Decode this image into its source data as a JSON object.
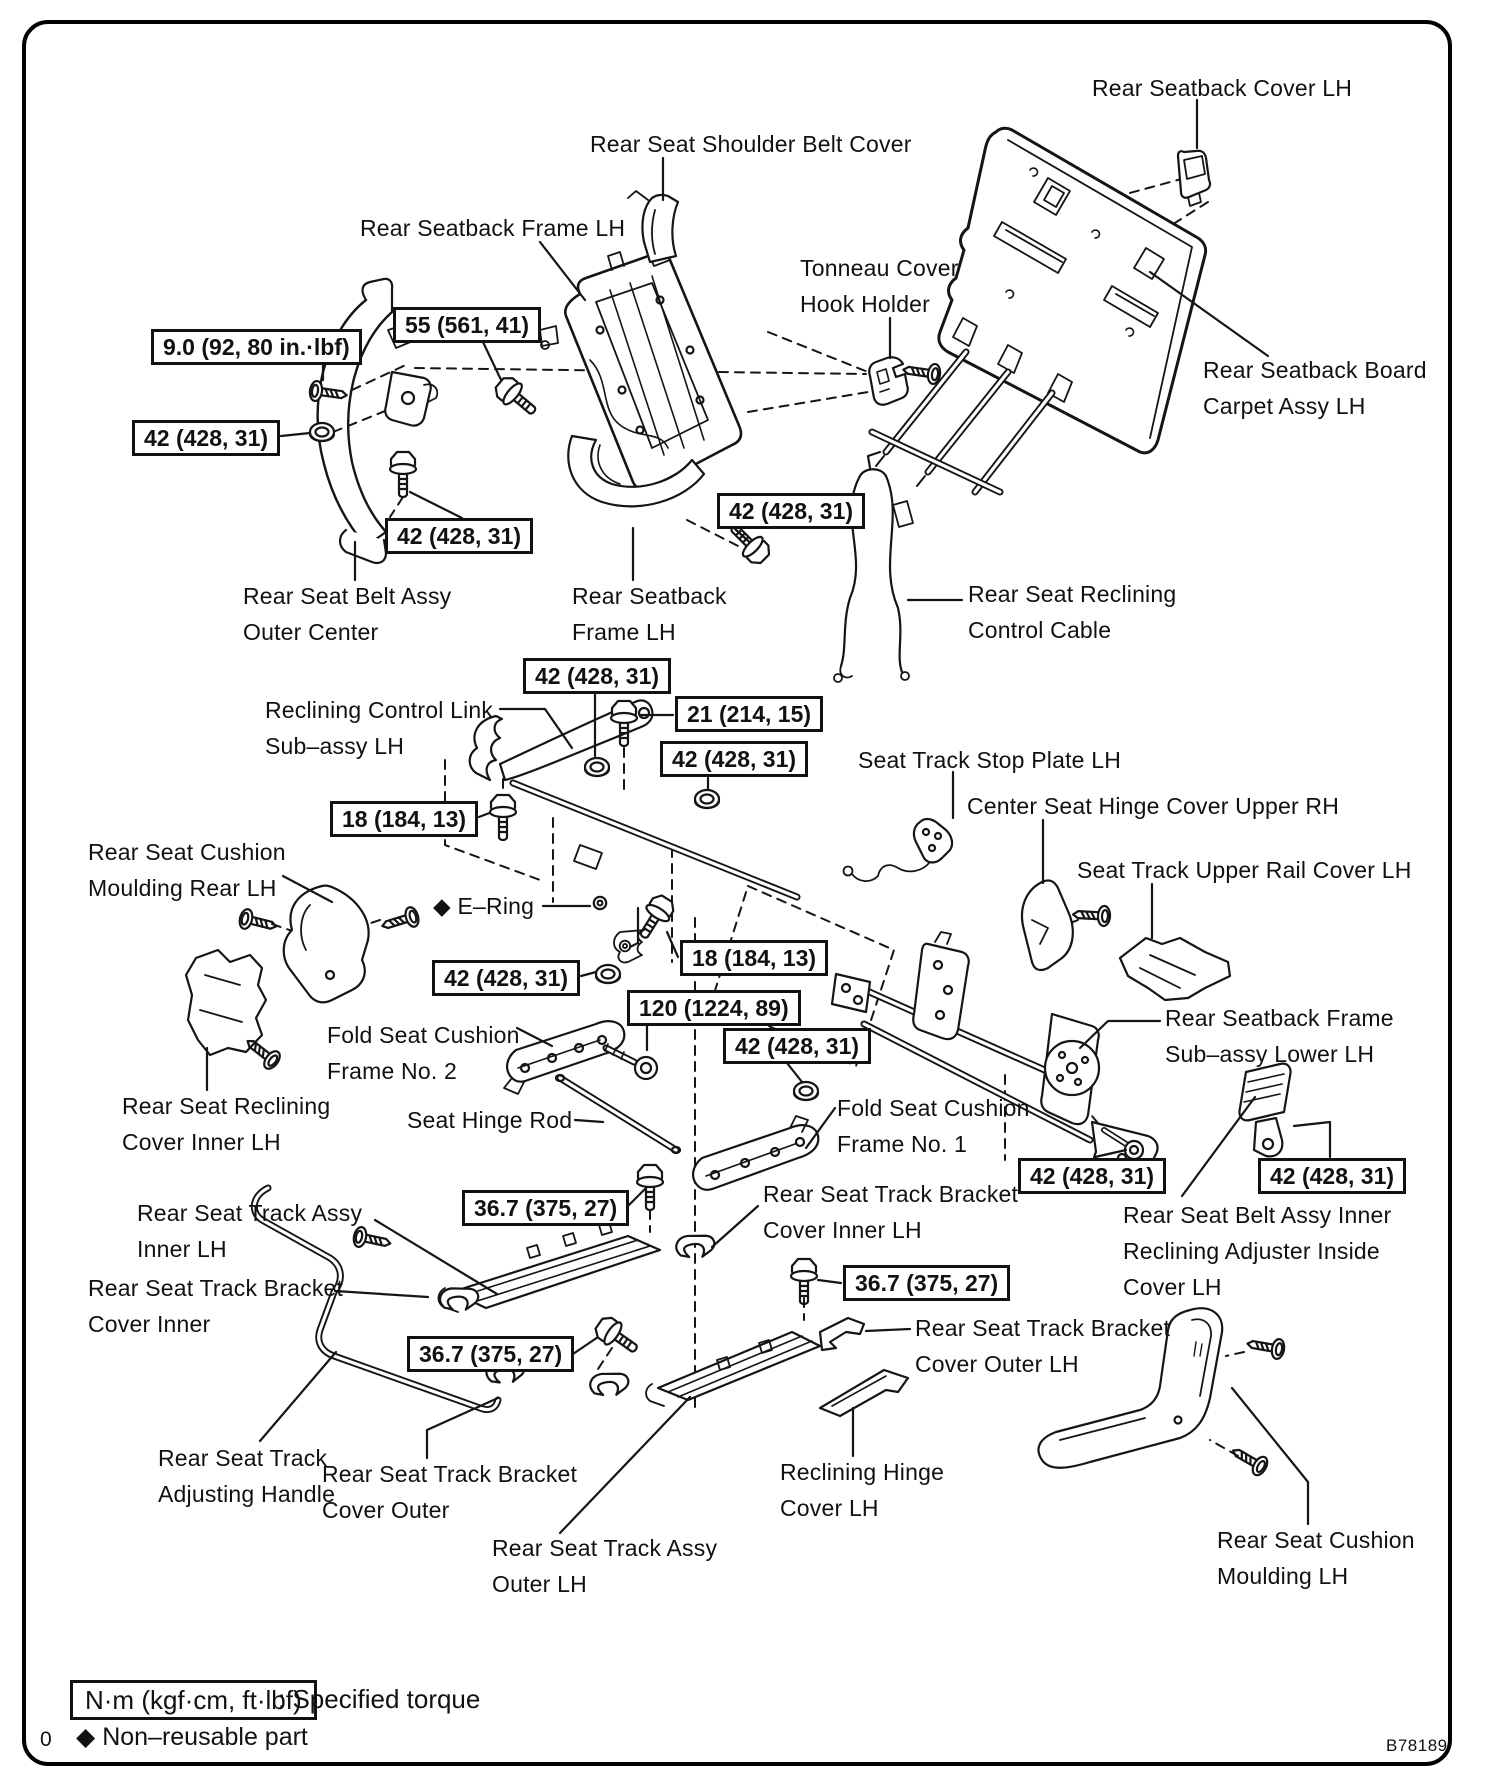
{
  "page": {
    "code": "B78189",
    "page_char": "0"
  },
  "legend": {
    "torque_box": "N·m (kgf·cm, ft·lbf)",
    "torque_note": ": Specified torque",
    "diamond": "◆",
    "non_reusable": "Non–reusable part"
  },
  "torque_boxes": [
    {
      "id": "t-9-0",
      "x": 151,
      "y": 329,
      "value": "9.0 (92, 80 in.·lbf)"
    },
    {
      "id": "t-55",
      "x": 393,
      "y": 307,
      "value": "55 (561, 41)"
    },
    {
      "id": "t-42-a",
      "x": 132,
      "y": 420,
      "value": "42 (428, 31)"
    },
    {
      "id": "t-42-b",
      "x": 385,
      "y": 518,
      "value": "42 (428, 31)"
    },
    {
      "id": "t-42-c",
      "x": 717,
      "y": 493,
      "value": "42 (428, 31)"
    },
    {
      "id": "t-42-d",
      "x": 523,
      "y": 658,
      "value": "42 (428, 31)"
    },
    {
      "id": "t-21",
      "x": 675,
      "y": 696,
      "value": "21 (214, 15)"
    },
    {
      "id": "t-42-e",
      "x": 660,
      "y": 741,
      "value": "42 (428, 31)"
    },
    {
      "id": "t-18-a",
      "x": 330,
      "y": 801,
      "value": "18 (184, 13)"
    },
    {
      "id": "t-18-b",
      "x": 680,
      "y": 940,
      "value": "18 (184, 13)"
    },
    {
      "id": "t-42-f",
      "x": 432,
      "y": 960,
      "value": "42 (428, 31)"
    },
    {
      "id": "t-120",
      "x": 627,
      "y": 990,
      "value": "120 (1224, 89)"
    },
    {
      "id": "t-42-g",
      "x": 723,
      "y": 1028,
      "value": "42 (428, 31)"
    },
    {
      "id": "t-36-a",
      "x": 462,
      "y": 1190,
      "value": "36.7 (375, 27)"
    },
    {
      "id": "t-36-b",
      "x": 407,
      "y": 1336,
      "value": "36.7 (375, 27)"
    },
    {
      "id": "t-36-c",
      "x": 843,
      "y": 1265,
      "value": "36.7 (375, 27)"
    },
    {
      "id": "t-42-h",
      "x": 1018,
      "y": 1158,
      "value": "42 (428, 31)"
    },
    {
      "id": "t-42-i",
      "x": 1258,
      "y": 1158,
      "value": "42 (428, 31)"
    }
  ],
  "part_labels": [
    {
      "id": "rear-seatback-cover-lh",
      "x": 1092,
      "y": 70,
      "lines": [
        "Rear Seatback Cover LH"
      ]
    },
    {
      "id": "rear-seat-shoulder-belt-cover",
      "x": 590,
      "y": 126,
      "lines": [
        "Rear Seat Shoulder Belt Cover"
      ]
    },
    {
      "id": "rear-seatback-frame-lh-top",
      "x": 360,
      "y": 210,
      "lines": [
        "Rear Seatback Frame LH"
      ]
    },
    {
      "id": "tonneau-cover-hook-holder",
      "x": 800,
      "y": 250,
      "lines": [
        "Tonneau Cover",
        "Hook Holder"
      ]
    },
    {
      "id": "rear-seatback-board-carpet-assy",
      "x": 1203,
      "y": 352,
      "lines": [
        "Rear Seatback Board",
        "Carpet Assy LH"
      ]
    },
    {
      "id": "rear-seat-belt-assy-outer-center",
      "x": 243,
      "y": 578,
      "lines": [
        "Rear Seat Belt Assy",
        "Outer Center"
      ]
    },
    {
      "id": "rear-seatback-frame-lh-mid",
      "x": 572,
      "y": 578,
      "lines": [
        "Rear Seatback",
        "Frame LH"
      ]
    },
    {
      "id": "rear-seat-reclining-control-cable",
      "x": 968,
      "y": 576,
      "lines": [
        "Rear Seat Reclining",
        "Control Cable"
      ]
    },
    {
      "id": "reclining-control-link-sub-assy",
      "x": 265,
      "y": 692,
      "lines": [
        "Reclining Control Link",
        "Sub–assy LH"
      ]
    },
    {
      "id": "seat-track-stop-plate-lh",
      "x": 858,
      "y": 742,
      "lines": [
        "Seat Track Stop Plate LH"
      ]
    },
    {
      "id": "center-seat-hinge-cover-upper-rh",
      "x": 967,
      "y": 788,
      "lines": [
        "Center Seat Hinge Cover Upper RH"
      ]
    },
    {
      "id": "seat-track-upper-rail-cover-lh",
      "x": 1077,
      "y": 852,
      "lines": [
        "Seat Track Upper Rail Cover LH"
      ]
    },
    {
      "id": "rear-seat-cushion-moulding-rear-lh",
      "x": 88,
      "y": 834,
      "lines": [
        "Rear Seat Cushion",
        "Moulding Rear LH"
      ]
    },
    {
      "id": "e-ring",
      "x": 433,
      "y": 888,
      "lines": [
        "◆ E–Ring"
      ]
    },
    {
      "id": "fold-seat-cushion-frame-no-2",
      "x": 327,
      "y": 1017,
      "lines": [
        "Fold Seat Cushion",
        "Frame No. 2"
      ]
    },
    {
      "id": "rear-seat-reclining-cover-inner-lh",
      "x": 122,
      "y": 1088,
      "lines": [
        "Rear Seat Reclining",
        "Cover In​ner LH"
      ]
    },
    {
      "id": "seat-hinge-rod",
      "x": 407,
      "y": 1102,
      "lines": [
        "Seat Hinge Rod"
      ]
    },
    {
      "id": "fold-seat-cushion-frame-no-1",
      "x": 837,
      "y": 1090,
      "lines": [
        "Fold Seat Cushion",
        "Frame No. 1"
      ]
    },
    {
      "id": "rear-seatback-frame-sub-assy-lower",
      "x": 1165,
      "y": 1000,
      "lines": [
        "Rear Seatback Frame",
        "Sub–assy Lower LH"
      ]
    },
    {
      "id": "rear-seat-belt-assy-inner",
      "x": 1123,
      "y": 1197,
      "lines": [
        "Rear Seat Belt Assy Inner",
        "Reclining Adjuster Inside",
        "Cover LH"
      ]
    },
    {
      "id": "rear-seat-track-assy-inner-lh",
      "x": 137,
      "y": 1195,
      "lines": [
        "Rear Seat Track Assy",
        "Inner LH"
      ]
    },
    {
      "id": "rear-seat-track-bracket-cover-inner",
      "x": 88,
      "y": 1270,
      "lines": [
        "Rear Seat Track Bracket",
        "Cover Inner"
      ]
    },
    {
      "id": "rear-seat-track-bracket-cover-inner-lh",
      "x": 763,
      "y": 1176,
      "lines": [
        "Rear Seat Track Bracket",
        "Cover Inner LH"
      ]
    },
    {
      "id": "rear-seat-track-bracket-cover-outer-lh",
      "x": 915,
      "y": 1310,
      "lines": [
        "Rear Seat Track Bracket",
        "Cover Outer LH"
      ]
    },
    {
      "id": "rear-seat-track-adjusting-handle",
      "x": 158,
      "y": 1440,
      "lines": [
        "Rear Seat Track",
        "Adjusting Handle"
      ]
    },
    {
      "id": "rear-seat-track-bracket-cover-outer",
      "x": 322,
      "y": 1456,
      "lines": [
        "Rear Seat Track Bracket",
        "Cover Outer"
      ]
    },
    {
      "id": "rear-seat-track-assy-outer-lh",
      "x": 492,
      "y": 1530,
      "lines": [
        "Rear Seat Track Assy",
        "Outer LH"
      ]
    },
    {
      "id": "reclining-hinge-cover-lh",
      "x": 780,
      "y": 1454,
      "lines": [
        "Reclining Hinge",
        "Cover LH"
      ]
    },
    {
      "id": "rear-seat-cushion-moulding-lh",
      "x": 1217,
      "y": 1522,
      "lines": [
        "Rear Seat Cushion",
        "Moulding LH"
      ]
    }
  ]
}
